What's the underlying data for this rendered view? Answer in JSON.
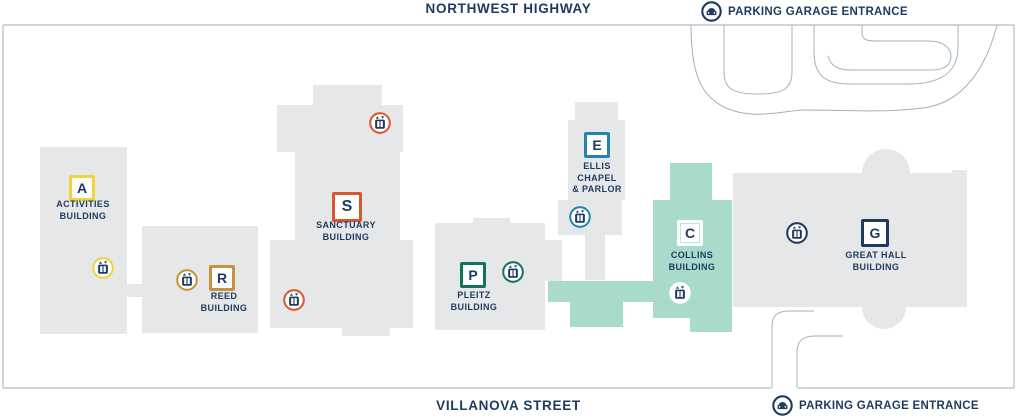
{
  "map": {
    "streets": {
      "top": "NORTHWEST HIGHWAY",
      "bottom": "VILLANOVA STREET"
    },
    "parking_entrances": {
      "top": "PARKING GARAGE ENTRANCE",
      "bottom": "PARKING GARAGE ENTRANCE"
    }
  },
  "buildings": {
    "activities": {
      "letter": "A",
      "line1": "ACTIVITIES",
      "line2": "BUILDING",
      "color": "#EFD43B"
    },
    "reed": {
      "letter": "R",
      "line1": "REED",
      "line2": "BUILDING",
      "color": "#C8913E"
    },
    "sanctuary": {
      "letter": "S",
      "line1": "SANCTUARY",
      "line2": "BUILDING",
      "color": "#D8572E"
    },
    "pleitz": {
      "letter": "P",
      "line1": "PLEITZ",
      "line2": "BUILDING",
      "color": "#13745B"
    },
    "ellis": {
      "letter": "E",
      "line1": "ELLIS",
      "line2": "CHAPEL",
      "line3": "& PARLOR",
      "color": "#2584AE"
    },
    "collins": {
      "letter": "C",
      "line1": "COLLINS",
      "line2": "BUILDING",
      "color": "#FFFFFF",
      "highlight_fill": "#A9DBCD",
      "badge_line": "#BFE3D8"
    },
    "great_hall": {
      "letter": "G",
      "line1": "GREAT HALL",
      "line2": "BUILDING",
      "color": "#1E3A5F"
    }
  },
  "icons": {
    "elevator": "elevator-icon",
    "parking": "car-icon"
  },
  "colors": {
    "navy": "#1E3A5F",
    "building_gray": "#E6E7E8",
    "mint": "#A9DBCD",
    "boundary_line": "#BCC7CF",
    "road_line": "#9FB3BF",
    "white": "#FFFFFF"
  }
}
